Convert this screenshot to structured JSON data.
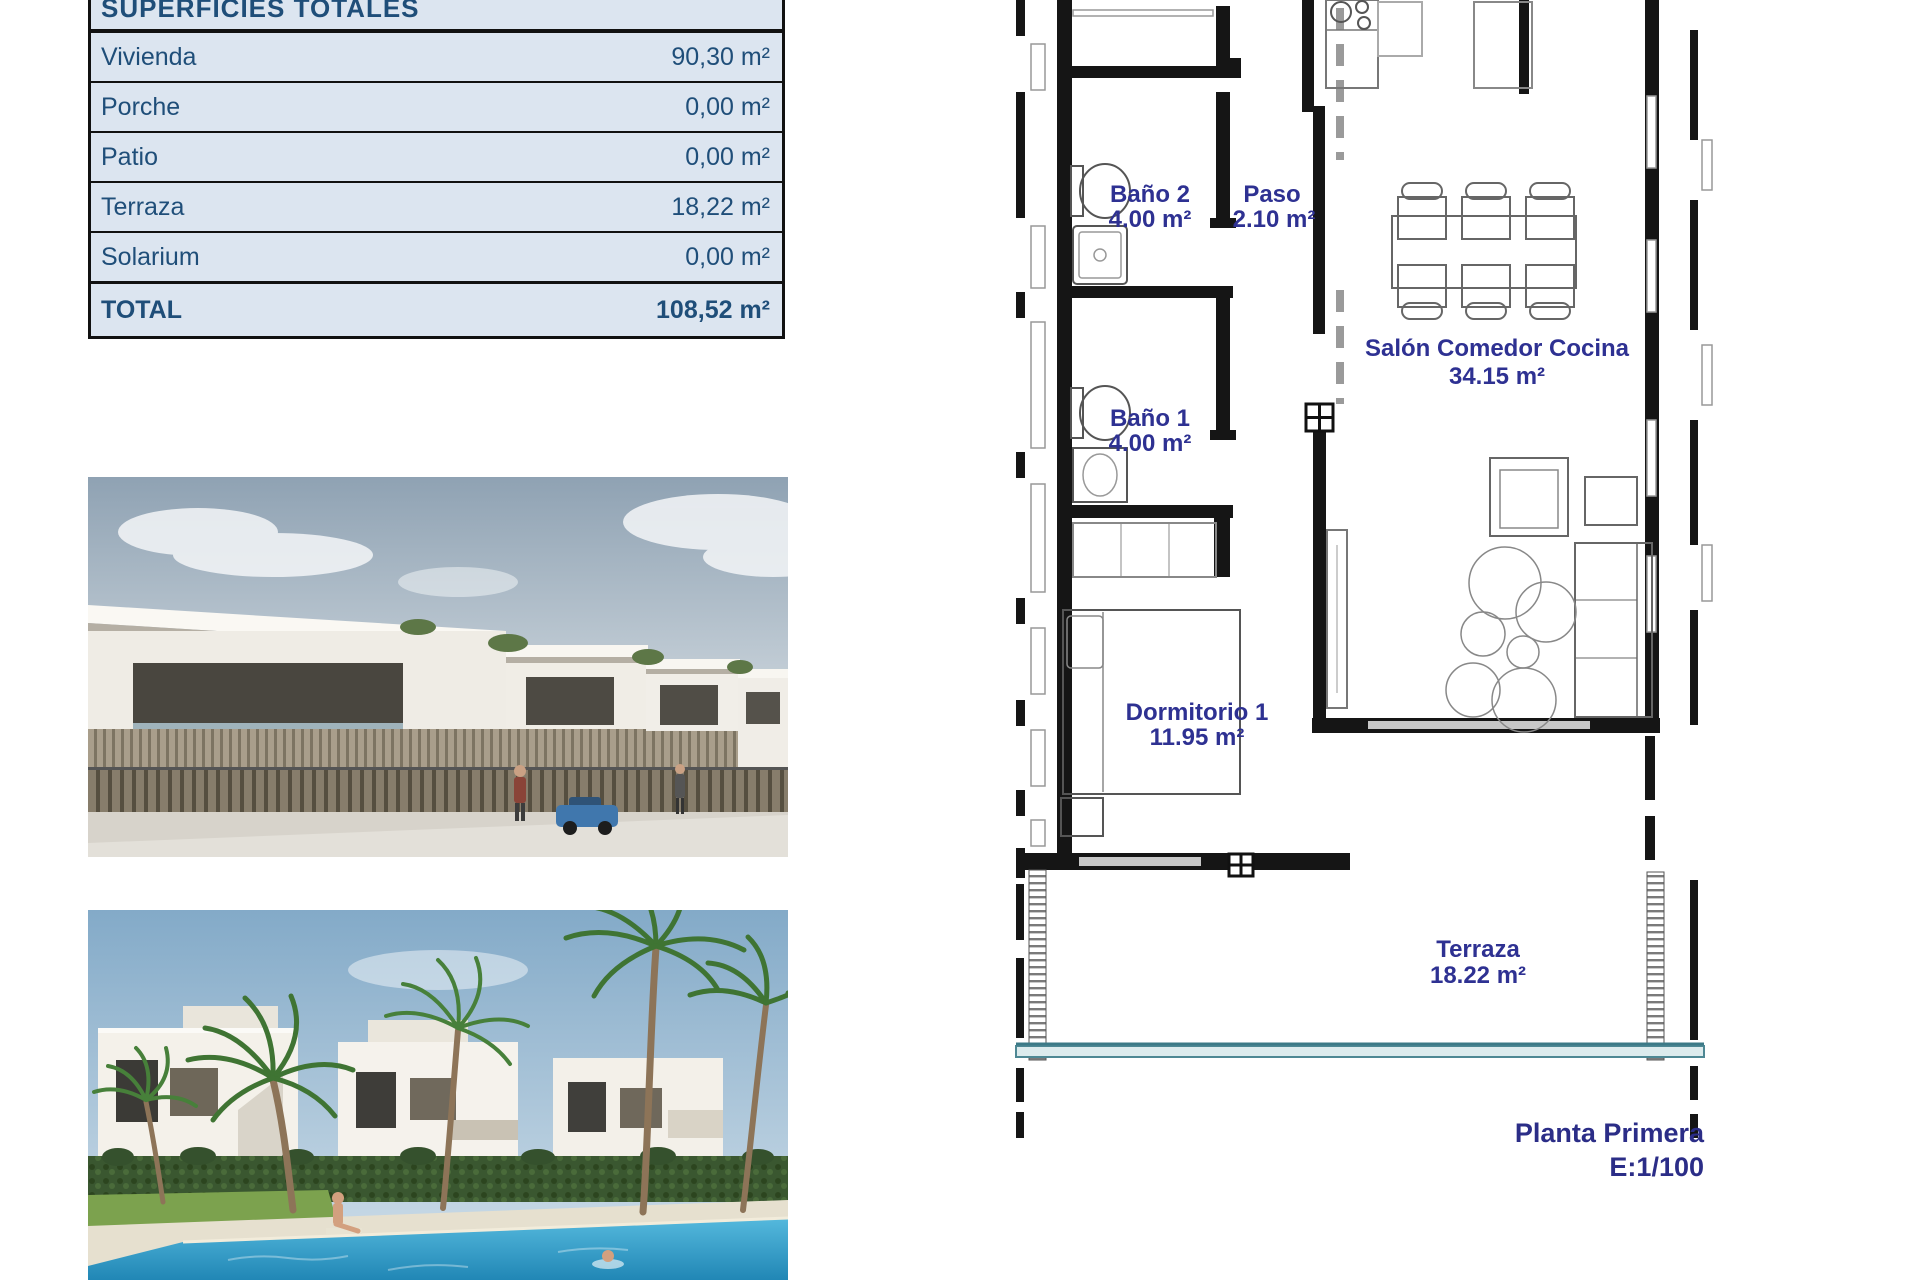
{
  "surfaces_table": {
    "title": "SUPERFICIES TOTALES",
    "rows": [
      {
        "label": "Vivienda",
        "value": "90,30 m²"
      },
      {
        "label": "Porche",
        "value": "0,00 m²"
      },
      {
        "label": "Patio",
        "value": "0,00 m²"
      },
      {
        "label": "Terraza",
        "value": "18,22 m²"
      },
      {
        "label": "Solarium",
        "value": "0,00 m²"
      }
    ],
    "total_row": {
      "label": "TOTAL",
      "value": "108,52 m²"
    },
    "colors": {
      "row_background": "#dce5f0",
      "text": "#1f4e79",
      "border": "#111111"
    }
  },
  "floor_plan": {
    "rooms": [
      {
        "name": "Baño 2",
        "area": "4.00 m²"
      },
      {
        "name": "Paso",
        "area": "2.10 m²"
      },
      {
        "name": "Salón Comedor Cocina",
        "area": "34.15 m²"
      },
      {
        "name": "Baño 1",
        "area": "4.00 m²"
      },
      {
        "name": "Dormitorio 1",
        "area": "11.95 m²"
      },
      {
        "name": "Terraza",
        "area": "18.22 m²"
      }
    ],
    "caption": {
      "title": "Planta Primera",
      "scale": "E:1/100"
    },
    "colors": {
      "label": "#2e3192",
      "caption": "#2b2d87",
      "wall": "#151515",
      "balustrade": "#4e8894"
    }
  },
  "photos": [
    {
      "name": "exterior-render"
    },
    {
      "name": "pool-render"
    }
  ]
}
